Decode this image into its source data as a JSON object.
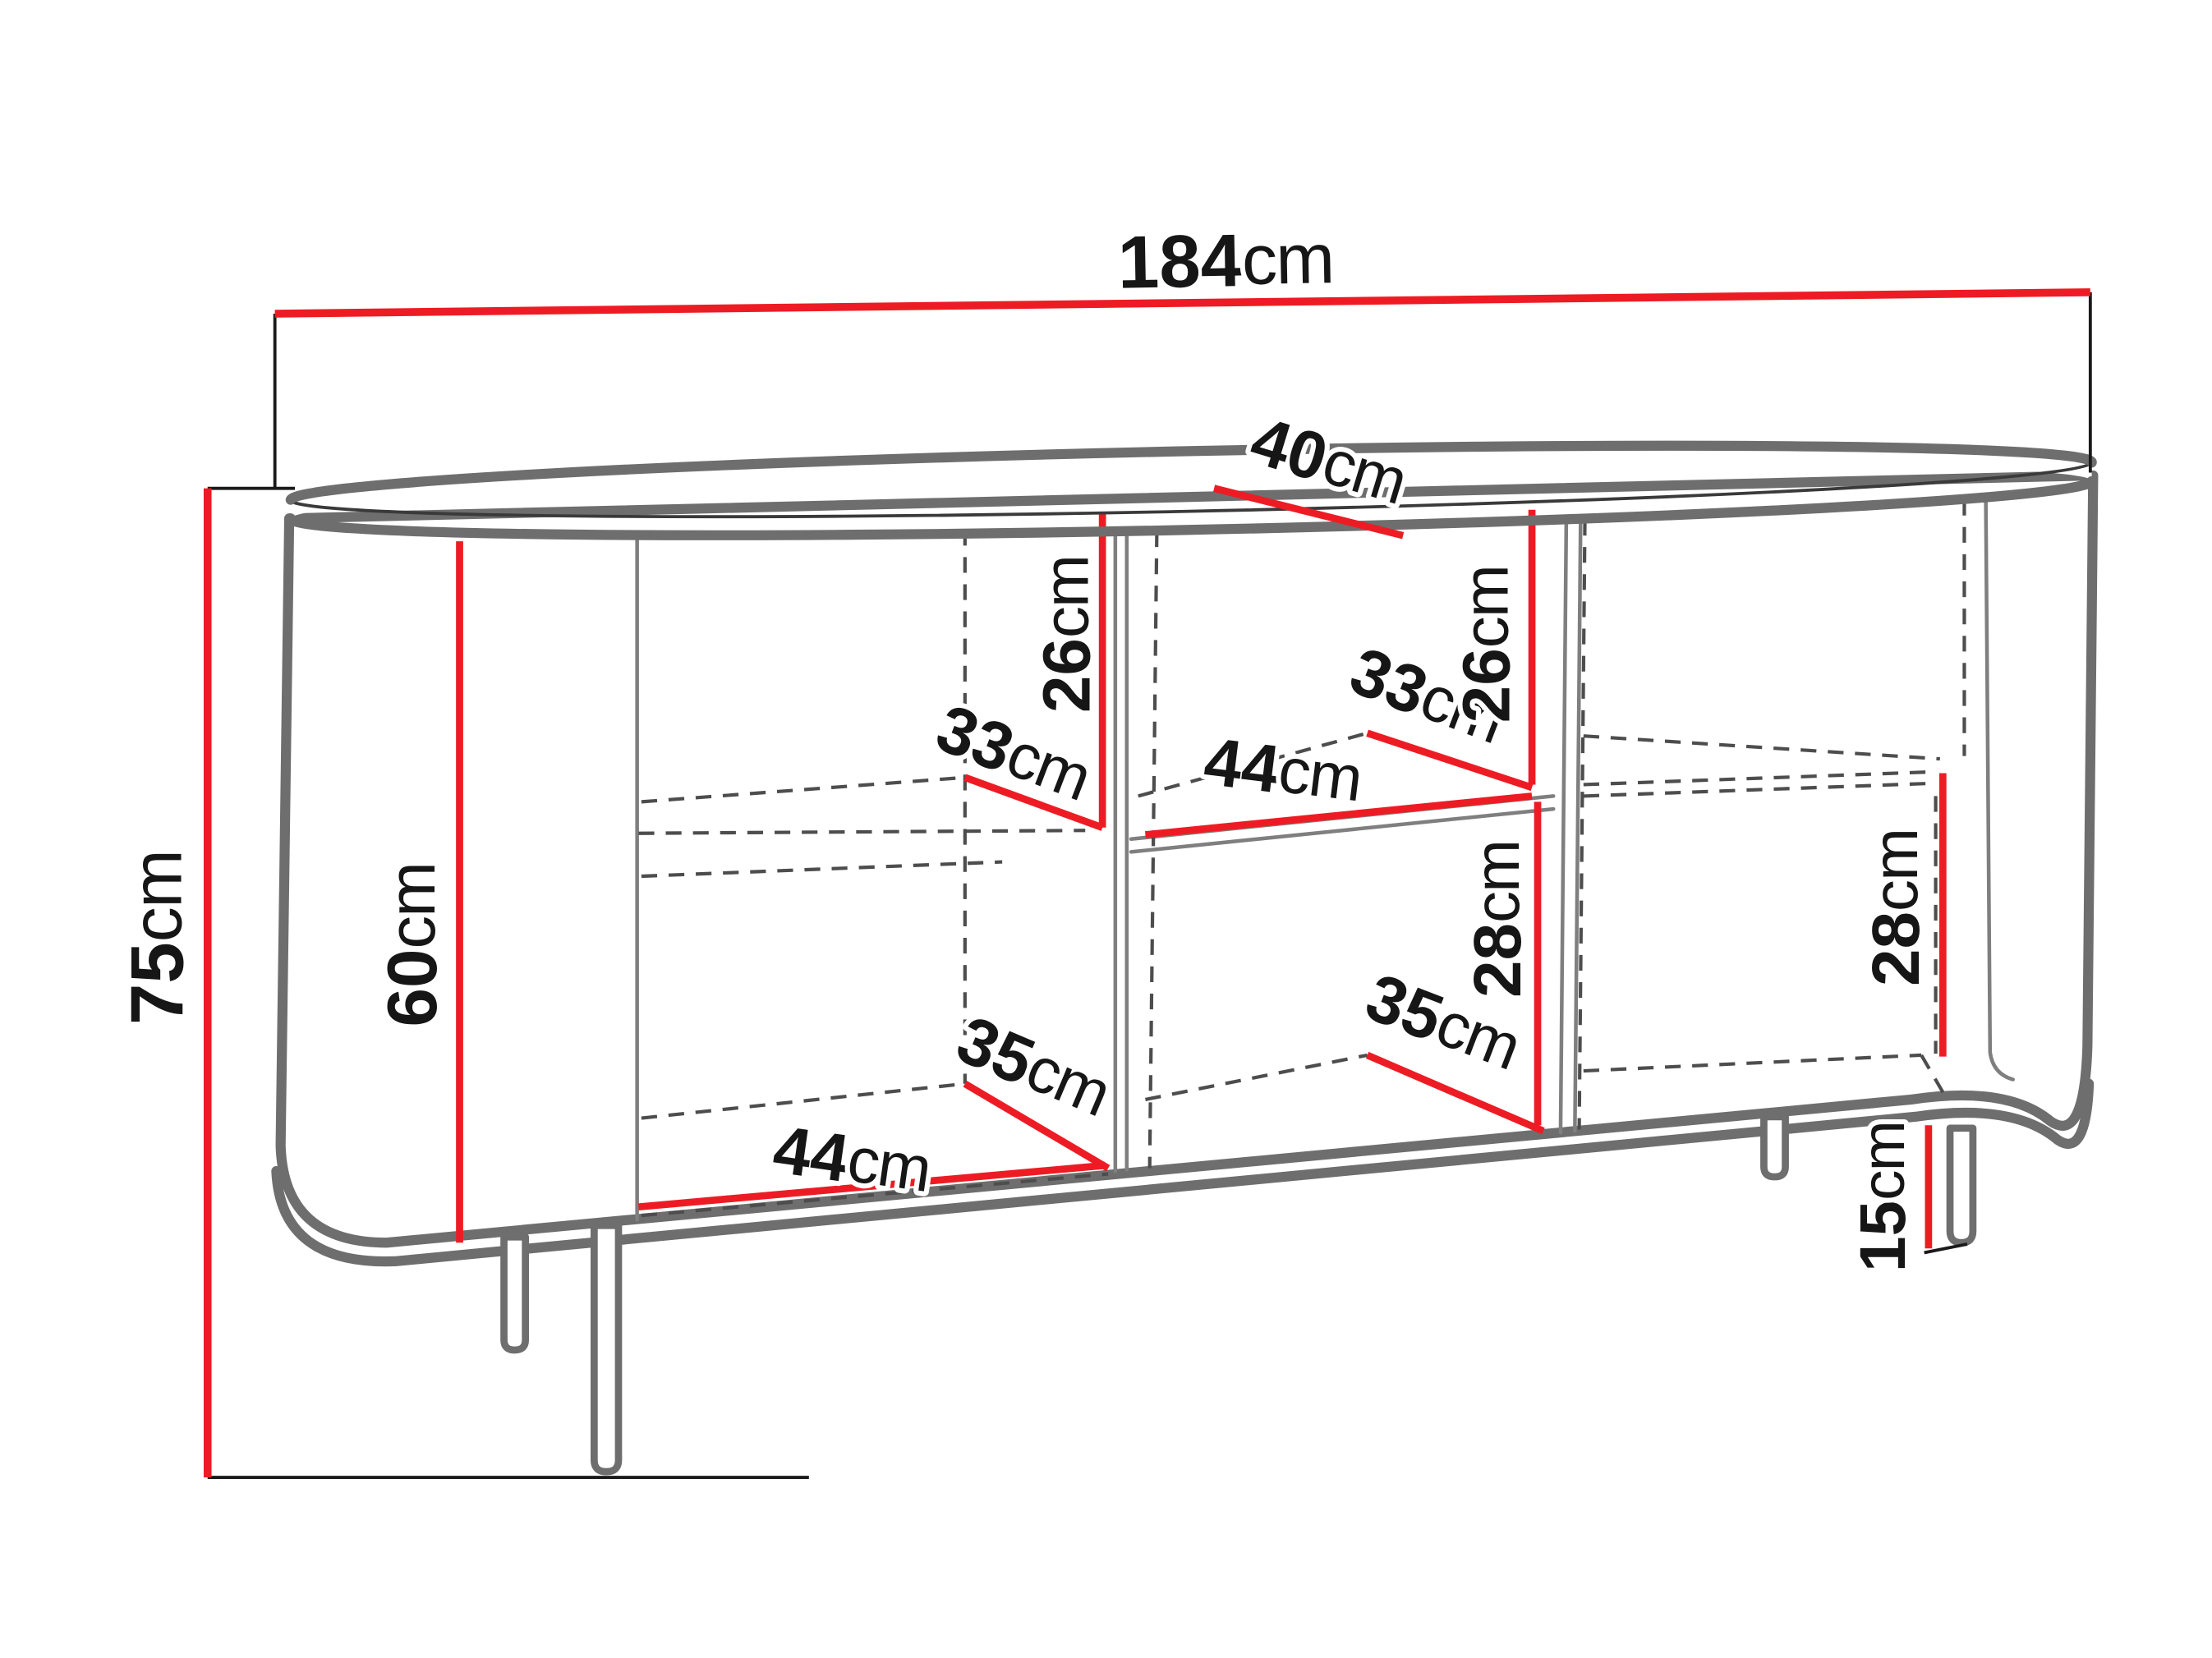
{
  "diagram_title": "sideboard dimension diagram",
  "colors": {
    "accent_red": "#ed1c24",
    "outline_gray": "#6e6e6e",
    "dash_gray": "#4d4d4d",
    "text_black": "#161616",
    "background": "#ffffff"
  },
  "labels": [
    {
      "id": "total-width",
      "value": "184",
      "unit": "cm"
    },
    {
      "id": "depth",
      "value": "40",
      "unit": "cm"
    },
    {
      "id": "total-height",
      "value": "75",
      "unit": "cm"
    },
    {
      "id": "interior-height",
      "value": "60",
      "unit": "cm"
    },
    {
      "id": "left-upper-height",
      "value": "26",
      "unit": "cm"
    },
    {
      "id": "left-shelf-depth",
      "value": "33",
      "unit": "cm"
    },
    {
      "id": "center-shelf-width",
      "value": "44",
      "unit": "cm"
    },
    {
      "id": "center-upper-depth",
      "value": "33",
      "unit": "cm"
    },
    {
      "id": "center-upper-height",
      "value": "26",
      "unit": "cm"
    },
    {
      "id": "center-lower-height",
      "value": "28",
      "unit": "cm"
    },
    {
      "id": "center-lower-depth",
      "value": "35",
      "unit": "cm"
    },
    {
      "id": "left-bottom-width",
      "value": "44",
      "unit": "cm"
    },
    {
      "id": "left-bottom-depth",
      "value": "35",
      "unit": "cm"
    },
    {
      "id": "right-lower-height",
      "value": "28",
      "unit": "cm"
    },
    {
      "id": "leg-height",
      "value": "15",
      "unit": "cm"
    }
  ]
}
